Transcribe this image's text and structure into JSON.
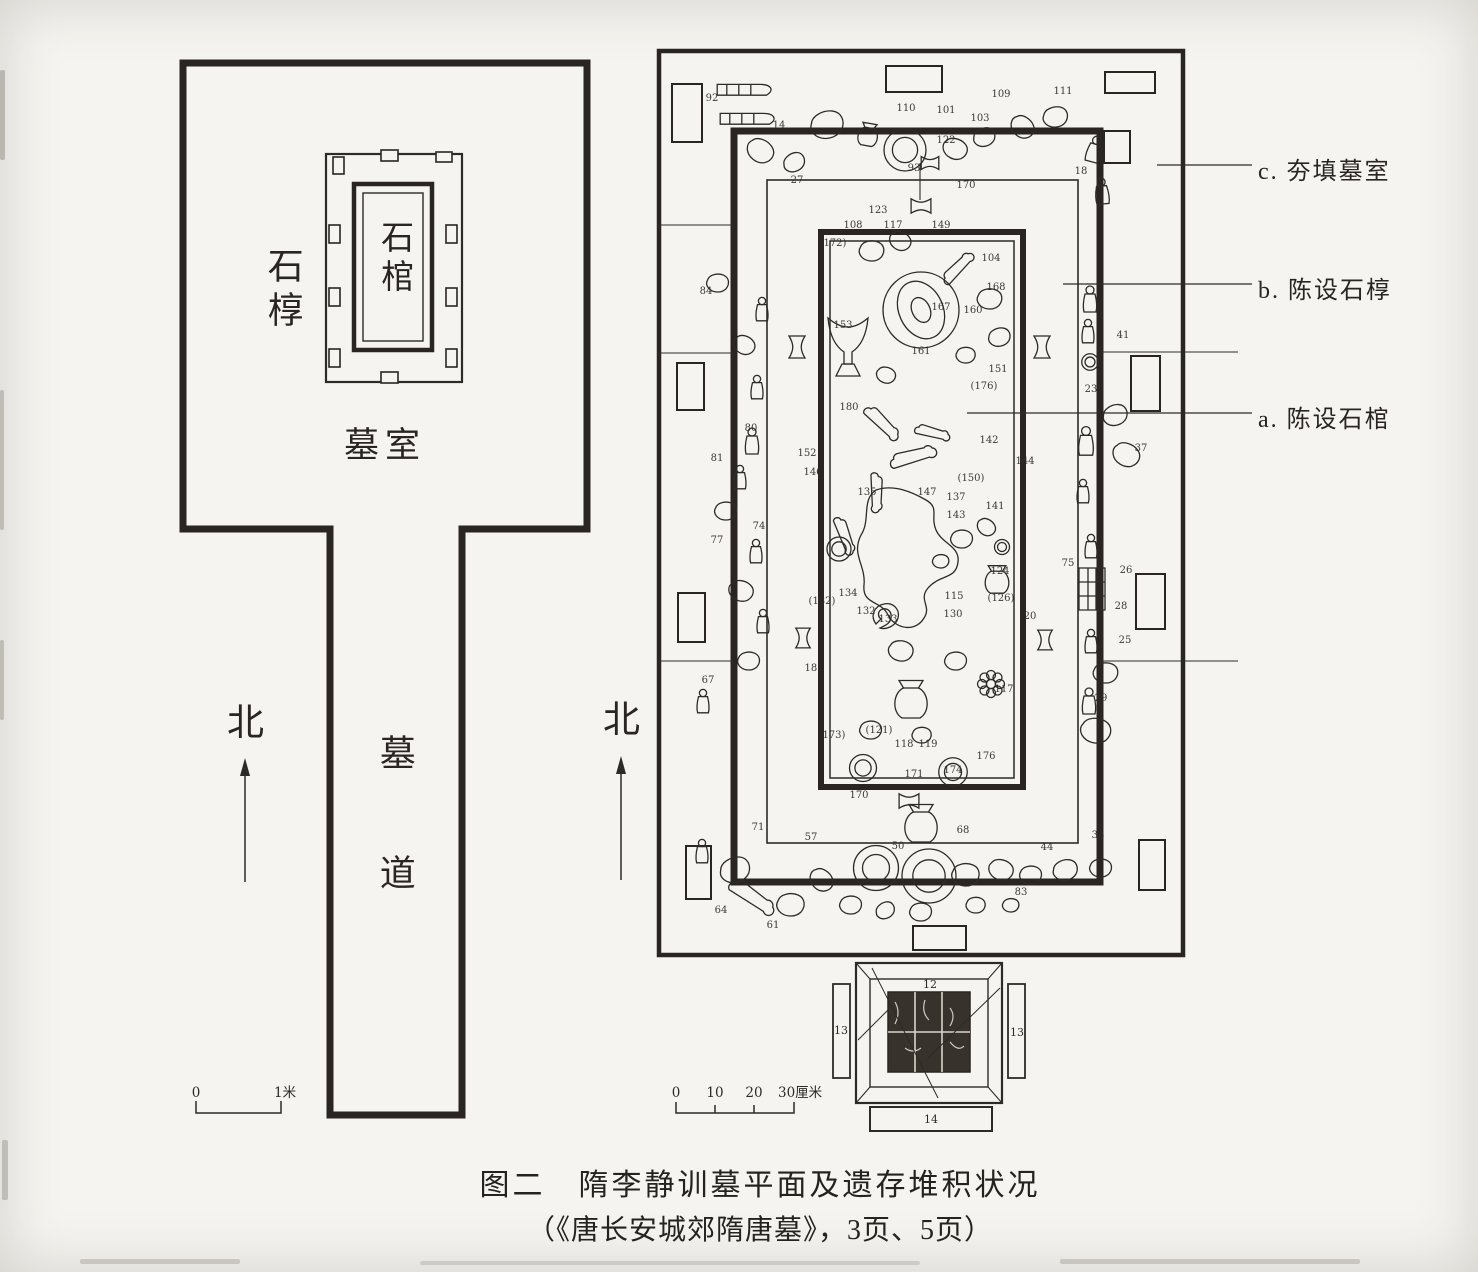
{
  "colors": {
    "paper": "#f5f4f0",
    "ink": "#2e2a27",
    "wall": "#2a2522"
  },
  "caption": {
    "line1": "图二　隋李静训墓平面及遗存堆积状况",
    "line2": "（《唐长安城郊隋唐墓》，3页、5页）"
  },
  "left_plan": {
    "labels": {
      "outer_coffin": "石椁",
      "coffin": "石棺",
      "chamber": "墓室",
      "passage": "墓道",
      "north": "北"
    },
    "scale": {
      "labels": [
        "0",
        "1米"
      ]
    }
  },
  "right_plan": {
    "north": "北",
    "annotations": [
      {
        "label": "c. 夯填墓室"
      },
      {
        "label": "b. 陈设石椁"
      },
      {
        "label": "a. 陈设石棺"
      }
    ],
    "scale": {
      "ticks": [
        "0",
        "10",
        "20",
        "30厘米"
      ]
    },
    "gate": {
      "numbers": {
        "top": "12",
        "left": "13",
        "right": "13",
        "bottom": "14"
      }
    },
    "numbers": [
      {
        "v": "92",
        "x": 712,
        "y": 101
      },
      {
        "v": "14",
        "x": 779,
        "y": 128
      },
      {
        "v": "110",
        "x": 906,
        "y": 111
      },
      {
        "v": "101",
        "x": 946,
        "y": 113
      },
      {
        "v": "109",
        "x": 1001,
        "y": 97
      },
      {
        "v": "111",
        "x": 1063,
        "y": 94
      },
      {
        "v": "103",
        "x": 980,
        "y": 121
      },
      {
        "v": "122",
        "x": 946,
        "y": 143
      },
      {
        "v": "93",
        "x": 914,
        "y": 171
      },
      {
        "v": "27",
        "x": 797,
        "y": 183
      },
      {
        "v": "18",
        "x": 1081,
        "y": 174
      },
      {
        "v": "170",
        "x": 966,
        "y": 188
      },
      {
        "v": "123",
        "x": 878,
        "y": 213
      },
      {
        "v": "108",
        "x": 853,
        "y": 228
      },
      {
        "v": "117",
        "x": 893,
        "y": 228
      },
      {
        "v": "149",
        "x": 941,
        "y": 228
      },
      {
        "v": "(172)",
        "x": 833,
        "y": 246
      },
      {
        "v": "104",
        "x": 991,
        "y": 261
      },
      {
        "v": "168",
        "x": 996,
        "y": 290
      },
      {
        "v": "167",
        "x": 941,
        "y": 310
      },
      {
        "v": "160",
        "x": 973,
        "y": 313
      },
      {
        "v": "153",
        "x": 843,
        "y": 328
      },
      {
        "v": "161",
        "x": 921,
        "y": 354
      },
      {
        "v": "151",
        "x": 998,
        "y": 372
      },
      {
        "v": "(176)",
        "x": 984,
        "y": 389
      },
      {
        "v": "180",
        "x": 849,
        "y": 410
      },
      {
        "v": "84",
        "x": 706,
        "y": 294
      },
      {
        "v": "80",
        "x": 751,
        "y": 431
      },
      {
        "v": "81",
        "x": 717,
        "y": 461
      },
      {
        "v": "74",
        "x": 759,
        "y": 529
      },
      {
        "v": "77",
        "x": 717,
        "y": 543
      },
      {
        "v": "(182)",
        "x": 822,
        "y": 604
      },
      {
        "v": "181",
        "x": 814,
        "y": 671
      },
      {
        "v": "67",
        "x": 708,
        "y": 683
      },
      {
        "v": "152",
        "x": 807,
        "y": 456
      },
      {
        "v": "142",
        "x": 989,
        "y": 443
      },
      {
        "v": "144",
        "x": 1025,
        "y": 464
      },
      {
        "v": "146",
        "x": 813,
        "y": 475
      },
      {
        "v": "135",
        "x": 867,
        "y": 495
      },
      {
        "v": "147",
        "x": 927,
        "y": 495
      },
      {
        "v": "(150)",
        "x": 971,
        "y": 481
      },
      {
        "v": "137",
        "x": 956,
        "y": 500
      },
      {
        "v": "141",
        "x": 995,
        "y": 509
      },
      {
        "v": "143",
        "x": 956,
        "y": 518
      },
      {
        "v": "134",
        "x": 848,
        "y": 596
      },
      {
        "v": "132",
        "x": 866,
        "y": 614
      },
      {
        "v": "133",
        "x": 888,
        "y": 622
      },
      {
        "v": "115",
        "x": 954,
        "y": 599
      },
      {
        "v": "(126)",
        "x": 1001,
        "y": 601
      },
      {
        "v": "130",
        "x": 953,
        "y": 617
      },
      {
        "v": "20",
        "x": 1030,
        "y": 619
      },
      {
        "v": "124",
        "x": 1000,
        "y": 574
      },
      {
        "v": "117",
        "x": 1004,
        "y": 692
      },
      {
        "v": "41",
        "x": 1123,
        "y": 338
      },
      {
        "v": "23",
        "x": 1091,
        "y": 392
      },
      {
        "v": "37",
        "x": 1141,
        "y": 451
      },
      {
        "v": "75",
        "x": 1068,
        "y": 566
      },
      {
        "v": "26",
        "x": 1126,
        "y": 573
      },
      {
        "v": "28",
        "x": 1121,
        "y": 609
      },
      {
        "v": "25",
        "x": 1125,
        "y": 643
      },
      {
        "v": "29",
        "x": 1101,
        "y": 701
      },
      {
        "v": "(173)",
        "x": 832,
        "y": 738
      },
      {
        "v": "(121)",
        "x": 879,
        "y": 733
      },
      {
        "v": "118",
        "x": 904,
        "y": 747
      },
      {
        "v": "119",
        "x": 928,
        "y": 747
      },
      {
        "v": "176",
        "x": 986,
        "y": 759
      },
      {
        "v": "174",
        "x": 953,
        "y": 773
      },
      {
        "v": "171",
        "x": 914,
        "y": 777
      },
      {
        "v": "170",
        "x": 859,
        "y": 798
      },
      {
        "v": "50",
        "x": 898,
        "y": 849
      },
      {
        "v": "44",
        "x": 1047,
        "y": 850
      },
      {
        "v": "68",
        "x": 963,
        "y": 833
      },
      {
        "v": "34",
        "x": 1098,
        "y": 838
      },
      {
        "v": "57",
        "x": 811,
        "y": 840
      },
      {
        "v": "71",
        "x": 758,
        "y": 830
      },
      {
        "v": "64",
        "x": 721,
        "y": 913
      },
      {
        "v": "61",
        "x": 773,
        "y": 928
      },
      {
        "v": "83",
        "x": 1021,
        "y": 895
      }
    ],
    "artifacts": [
      {
        "t": "sled",
        "x": 746,
        "y": 94,
        "s": 1.2,
        "r": 0
      },
      {
        "t": "sled",
        "x": 749,
        "y": 123,
        "s": 1.2,
        "r": 0
      },
      {
        "t": "blob",
        "x": 828,
        "y": 126,
        "s": 1.2,
        "r": -15
      },
      {
        "t": "pot",
        "x": 868,
        "y": 135,
        "s": 0.9,
        "r": 10
      },
      {
        "t": "circle2",
        "x": 905,
        "y": 150,
        "s": 1.4,
        "r": 0
      },
      {
        "t": "blob",
        "x": 955,
        "y": 150,
        "s": 0.9,
        "r": 25
      },
      {
        "t": "blob",
        "x": 985,
        "y": 138,
        "s": 0.8,
        "r": -20
      },
      {
        "t": "blob",
        "x": 1022,
        "y": 128,
        "s": 0.9,
        "r": 45
      },
      {
        "t": "blob",
        "x": 1056,
        "y": 118,
        "s": 0.9,
        "r": -10
      },
      {
        "t": "figurine",
        "x": 1094,
        "y": 150,
        "s": 1,
        "r": 15
      },
      {
        "t": "figurine",
        "x": 1102,
        "y": 192,
        "s": 1,
        "r": -5
      },
      {
        "t": "blob",
        "x": 760,
        "y": 152,
        "s": 1,
        "r": 35
      },
      {
        "t": "blob",
        "x": 795,
        "y": 163,
        "s": 0.8,
        "r": -30
      },
      {
        "t": "bowtie",
        "x": 921,
        "y": 206,
        "s": 0.9,
        "r": 0
      },
      {
        "t": "bowtie",
        "x": 930,
        "y": 163,
        "s": 0.8,
        "r": 0
      },
      {
        "t": "blob",
        "x": 718,
        "y": 284,
        "s": 0.8,
        "r": 0
      },
      {
        "t": "figurine",
        "x": 762,
        "y": 310,
        "s": 0.9,
        "r": 0
      },
      {
        "t": "blob",
        "x": 744,
        "y": 346,
        "s": 0.8,
        "r": 30
      },
      {
        "t": "bowtie",
        "x": 797,
        "y": 347,
        "s": 1,
        "r": 90
      },
      {
        "t": "figurine",
        "x": 757,
        "y": 388,
        "s": 0.9,
        "r": 0
      },
      {
        "t": "figurine",
        "x": 752,
        "y": 442,
        "s": 1,
        "r": 0
      },
      {
        "t": "figurine",
        "x": 740,
        "y": 478,
        "s": 0.9,
        "r": 0
      },
      {
        "t": "blob",
        "x": 726,
        "y": 512,
        "s": 0.8,
        "r": 0
      },
      {
        "t": "figurine",
        "x": 756,
        "y": 552,
        "s": 0.9,
        "r": 0
      },
      {
        "t": "blob",
        "x": 741,
        "y": 592,
        "s": 0.9,
        "r": 20
      },
      {
        "t": "figurine",
        "x": 763,
        "y": 622,
        "s": 0.9,
        "r": 0
      },
      {
        "t": "bowtie",
        "x": 803,
        "y": 638,
        "s": 0.9,
        "r": 90
      },
      {
        "t": "blob",
        "x": 749,
        "y": 662,
        "s": 0.8,
        "r": 0
      },
      {
        "t": "figurine",
        "x": 703,
        "y": 702,
        "s": 0.9,
        "r": 0
      },
      {
        "t": "cup",
        "x": 848,
        "y": 348,
        "s": 2,
        "r": 0
      },
      {
        "t": "mirror",
        "x": 921,
        "y": 310,
        "s": 1,
        "r": 0
      },
      {
        "t": "blob",
        "x": 872,
        "y": 252,
        "s": 0.9,
        "r": 0
      },
      {
        "t": "blob",
        "x": 900,
        "y": 242,
        "s": 0.8,
        "r": 30
      },
      {
        "t": "bone",
        "x": 957,
        "y": 268,
        "s": 1,
        "r": -55
      },
      {
        "t": "blob",
        "x": 990,
        "y": 300,
        "s": 0.9,
        "r": 0
      },
      {
        "t": "blob",
        "x": 1000,
        "y": 338,
        "s": 0.8,
        "r": -15
      },
      {
        "t": "blob",
        "x": 966,
        "y": 356,
        "s": 0.7,
        "r": 0
      },
      {
        "t": "blob",
        "x": 886,
        "y": 376,
        "s": 0.7,
        "r": 20
      },
      {
        "t": "bone",
        "x": 882,
        "y": 422,
        "s": 1.1,
        "r": 35
      },
      {
        "t": "bone",
        "x": 912,
        "y": 456,
        "s": 1.2,
        "r": -25
      },
      {
        "t": "bone",
        "x": 877,
        "y": 492,
        "s": 1,
        "r": 80
      },
      {
        "t": "bone",
        "x": 932,
        "y": 432,
        "s": 0.9,
        "r": 5
      },
      {
        "t": "bone",
        "x": 845,
        "y": 535,
        "s": 1,
        "r": 60
      },
      {
        "t": "circle2",
        "x": 839,
        "y": 549,
        "s": 0.8,
        "r": 0
      },
      {
        "t": "stain",
        "x": 906,
        "y": 560,
        "s": 1,
        "r": 0
      },
      {
        "t": "shell",
        "x": 886,
        "y": 616,
        "s": 1,
        "r": 0
      },
      {
        "t": "pot",
        "x": 997,
        "y": 580,
        "s": 1.1,
        "r": 0
      },
      {
        "t": "blob",
        "x": 962,
        "y": 540,
        "s": 0.8,
        "r": 0
      },
      {
        "t": "blob",
        "x": 986,
        "y": 528,
        "s": 0.7,
        "r": 40
      },
      {
        "t": "circle2",
        "x": 1002,
        "y": 547,
        "s": 0.5,
        "r": 0
      },
      {
        "t": "blob",
        "x": 941,
        "y": 562,
        "s": 0.6,
        "r": 0
      },
      {
        "t": "blob",
        "x": 901,
        "y": 652,
        "s": 0.9,
        "r": 10
      },
      {
        "t": "pot",
        "x": 911,
        "y": 700,
        "s": 1.5,
        "r": 0
      },
      {
        "t": "flower",
        "x": 991,
        "y": 684,
        "s": 1,
        "r": 0
      },
      {
        "t": "blob",
        "x": 956,
        "y": 662,
        "s": 0.8,
        "r": 0
      },
      {
        "t": "circle2",
        "x": 953,
        "y": 772,
        "s": 0.95,
        "r": 0
      },
      {
        "t": "blob",
        "x": 871,
        "y": 731,
        "s": 0.8,
        "r": 0
      },
      {
        "t": "blob",
        "x": 922,
        "y": 736,
        "s": 0.7,
        "r": 0
      },
      {
        "t": "circle2",
        "x": 863,
        "y": 768,
        "s": 0.9,
        "r": 0
      },
      {
        "t": "bowtie",
        "x": 909,
        "y": 801,
        "s": 0.9,
        "r": 0
      },
      {
        "t": "figurine",
        "x": 1090,
        "y": 300,
        "s": 1,
        "r": 0
      },
      {
        "t": "figurine",
        "x": 1088,
        "y": 332,
        "s": 0.9,
        "r": 0
      },
      {
        "t": "circle2",
        "x": 1090,
        "y": 362,
        "s": 0.55,
        "r": 0
      },
      {
        "t": "figurine",
        "x": 1086,
        "y": 442,
        "s": 1.1,
        "r": 0
      },
      {
        "t": "figurine",
        "x": 1083,
        "y": 492,
        "s": 0.9,
        "r": 0
      },
      {
        "t": "blob",
        "x": 1116,
        "y": 416,
        "s": 0.9,
        "r": -20
      },
      {
        "t": "blob",
        "x": 1126,
        "y": 456,
        "s": 1,
        "r": 30
      },
      {
        "t": "figurine",
        "x": 1091,
        "y": 547,
        "s": 0.9,
        "r": 0
      },
      {
        "t": "crate",
        "x": 1092,
        "y": 589,
        "s": 1,
        "r": 0
      },
      {
        "t": "figurine",
        "x": 1091,
        "y": 642,
        "s": 0.9,
        "r": 0
      },
      {
        "t": "blob",
        "x": 1106,
        "y": 674,
        "s": 0.9,
        "r": 0
      },
      {
        "t": "figurine",
        "x": 1089,
        "y": 702,
        "s": 1,
        "r": 0
      },
      {
        "t": "blob",
        "x": 1096,
        "y": 732,
        "s": 1.1,
        "r": 10
      },
      {
        "t": "bowtie",
        "x": 1042,
        "y": 347,
        "s": 1,
        "r": 90
      },
      {
        "t": "bowtie",
        "x": 1045,
        "y": 640,
        "s": 0.9,
        "r": 90
      },
      {
        "t": "circle2",
        "x": 876,
        "y": 868,
        "s": 1.5,
        "r": 0
      },
      {
        "t": "circle2",
        "x": 929,
        "y": 876,
        "s": 1.8,
        "r": 0
      },
      {
        "t": "pot",
        "x": 921,
        "y": 824,
        "s": 1.5,
        "r": 0
      },
      {
        "t": "blob",
        "x": 736,
        "y": 871,
        "s": 1.1,
        "r": -20
      },
      {
        "t": "bone",
        "x": 752,
        "y": 896,
        "s": 1.3,
        "r": 25
      },
      {
        "t": "blob",
        "x": 791,
        "y": 906,
        "s": 1,
        "r": 0
      },
      {
        "t": "blob",
        "x": 821,
        "y": 881,
        "s": 0.9,
        "r": 45
      },
      {
        "t": "figurine",
        "x": 702,
        "y": 852,
        "s": 0.9,
        "r": 0
      },
      {
        "t": "blob",
        "x": 851,
        "y": 906,
        "s": 0.8,
        "r": 0
      },
      {
        "t": "blob",
        "x": 886,
        "y": 911,
        "s": 0.7,
        "r": -30
      },
      {
        "t": "blob",
        "x": 921,
        "y": 913,
        "s": 0.8,
        "r": 0
      },
      {
        "t": "blob",
        "x": 966,
        "y": 876,
        "s": 1,
        "r": 0
      },
      {
        "t": "blob",
        "x": 1001,
        "y": 871,
        "s": 0.9,
        "r": 20
      },
      {
        "t": "blob",
        "x": 1031,
        "y": 876,
        "s": 0.8,
        "r": 0
      },
      {
        "t": "blob",
        "x": 1066,
        "y": 871,
        "s": 0.9,
        "r": -15
      },
      {
        "t": "blob",
        "x": 1101,
        "y": 869,
        "s": 0.8,
        "r": 0
      },
      {
        "t": "blob",
        "x": 976,
        "y": 906,
        "s": 0.7,
        "r": 0
      },
      {
        "t": "blob",
        "x": 1011,
        "y": 906,
        "s": 0.6,
        "r": 0
      }
    ]
  }
}
